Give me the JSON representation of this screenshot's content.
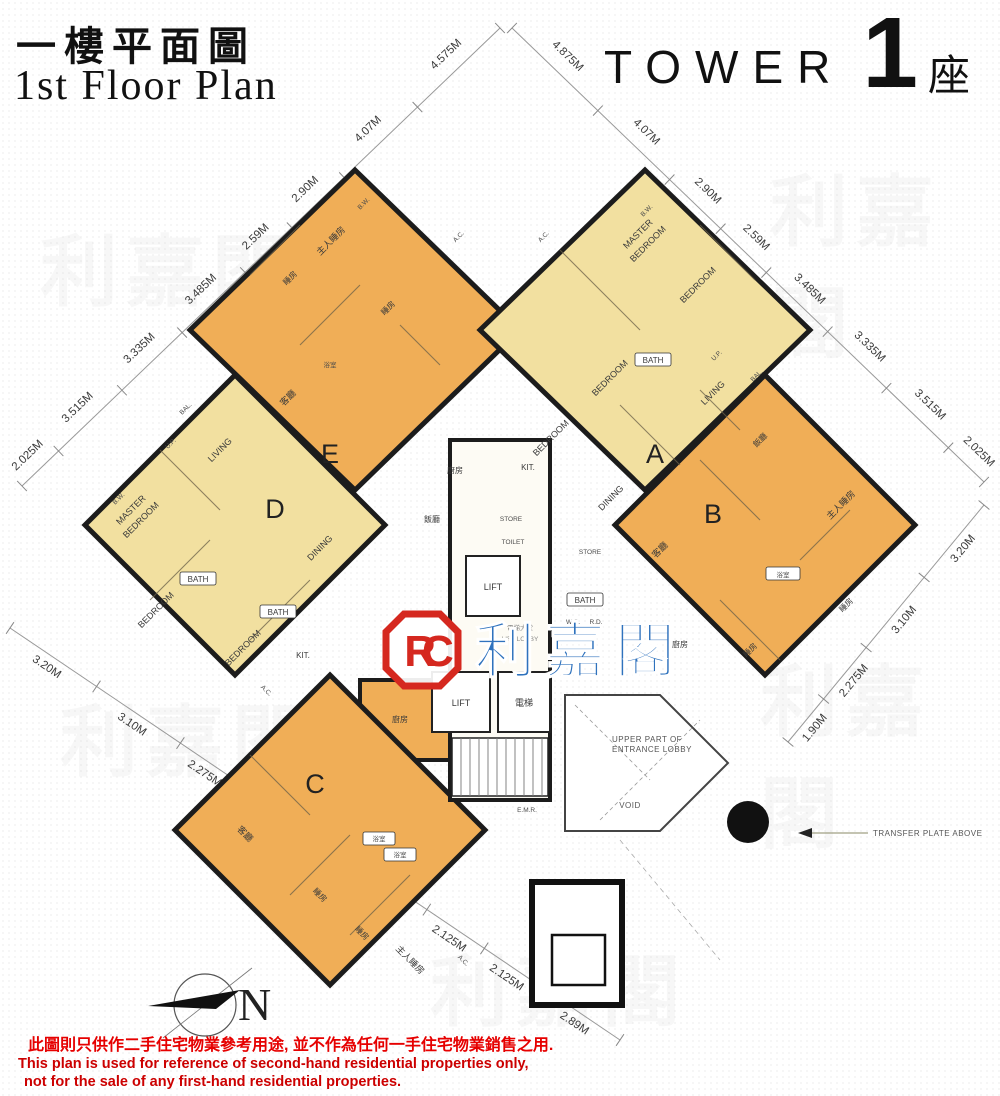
{
  "header": {
    "title_zh": "一樓平面圖",
    "title_en": "1st Floor Plan",
    "tower_label": "TOWER",
    "tower_number": "1",
    "tower_suffix": "座"
  },
  "logo": {
    "monogram": "RC",
    "brand": "利嘉閣"
  },
  "core": {
    "lift1": "LIFT",
    "lift2": "LIFT",
    "lift_zh": "電梯",
    "store": "STORE",
    "toilet": "TOILET",
    "emr": "E.M.R.",
    "lobby_zh": "電梯大堂",
    "lobby_en": "LIFT LOBBY"
  },
  "units": {
    "a": {
      "letter": "A",
      "master": "MASTER BEDROOM",
      "master_l1": "MASTER",
      "master_l2": "BEDROOM",
      "bedroom1": "BEDROOM",
      "bedroom2": "BEDROOM",
      "bedroom3": "BEDROOM",
      "bath1": "BATH",
      "bath2": "BATH",
      "living": "LIVING",
      "dining": "DINING",
      "kit": "KIT.",
      "store": "STORE",
      "bal": "BAL."
    },
    "b": {
      "letter": "B",
      "living": "客廳",
      "dining": "飯廳",
      "master": "主人睡房",
      "bedroom1": "睡房",
      "bedroom2": "睡房",
      "bath": "浴室",
      "kitchen": "廚房"
    },
    "c": {
      "letter": "C",
      "living": "客廳",
      "master": "主人睡房",
      "bedroom1": "睡房",
      "bedroom2": "睡房",
      "bath1": "浴室",
      "bath2": "浴室",
      "kitchen": "廚房"
    },
    "d": {
      "letter": "D",
      "master_l1": "MASTER",
      "master_l2": "BEDROOM",
      "bedroom1": "BEDROOM",
      "bedroom2": "BEDROOM",
      "bath1": "BATH",
      "bath2": "BATH",
      "living": "LIVING",
      "dining": "DINING",
      "kit": "KIT.",
      "bal": "BAL.",
      "up": "U.P."
    },
    "e": {
      "letter": "E",
      "master": "主人睡房",
      "bedroom1": "睡房",
      "bedroom2": "睡房",
      "living": "客廳",
      "dining": "飯廳",
      "bath": "浴室",
      "kitchen": "廚房"
    }
  },
  "small_labels": {
    "ac": "A.C.",
    "bw": "B.W.",
    "up": "U.P.",
    "wc": "W.C.",
    "rd": "R.D."
  },
  "annotations": {
    "entrance_lobby_l1": "UPPER PART OF",
    "entrance_lobby_l2": "ENTRANCE LOBBY",
    "void": "VOID",
    "transfer_plate": "TRANSFER PLATE ABOVE",
    "north": "N"
  },
  "dims": {
    "upper_left": [
      "4.575M",
      "4.07M",
      "2.90M",
      "2.59M",
      "3.485M",
      "3.335M",
      "3.515M",
      "2.025M"
    ],
    "upper_right": [
      "4.875M",
      "4.07M",
      "2.90M",
      "2.59M",
      "3.485M",
      "3.335M",
      "3.515M",
      "2.025M"
    ],
    "lower_left": [
      "3.20M",
      "3.10M",
      "2.275M",
      "1.90M",
      "1.50M",
      "3.435M",
      "2.125M",
      "2.125M",
      "2.89M"
    ],
    "lower_right": [
      "3.20M",
      "3.10M",
      "2.275M",
      "1.90M"
    ]
  },
  "disclaimer": {
    "zh": "此圖則只供作二手住宅物業參考用途, 並不作為任何一手住宅物業銷售之用.",
    "en1": "This plan is used for reference of second-hand residential properties only,",
    "en2": "not for the sale of any first-hand residential properties."
  },
  "colors": {
    "unit_yellow": "#f2e0a0",
    "unit_orange": "#f0ae57",
    "wall": "#1c1c1c",
    "logo_red": "#d5281f",
    "brand_blue": "#2f72bd",
    "disclaimer_red": "#cc0000"
  }
}
